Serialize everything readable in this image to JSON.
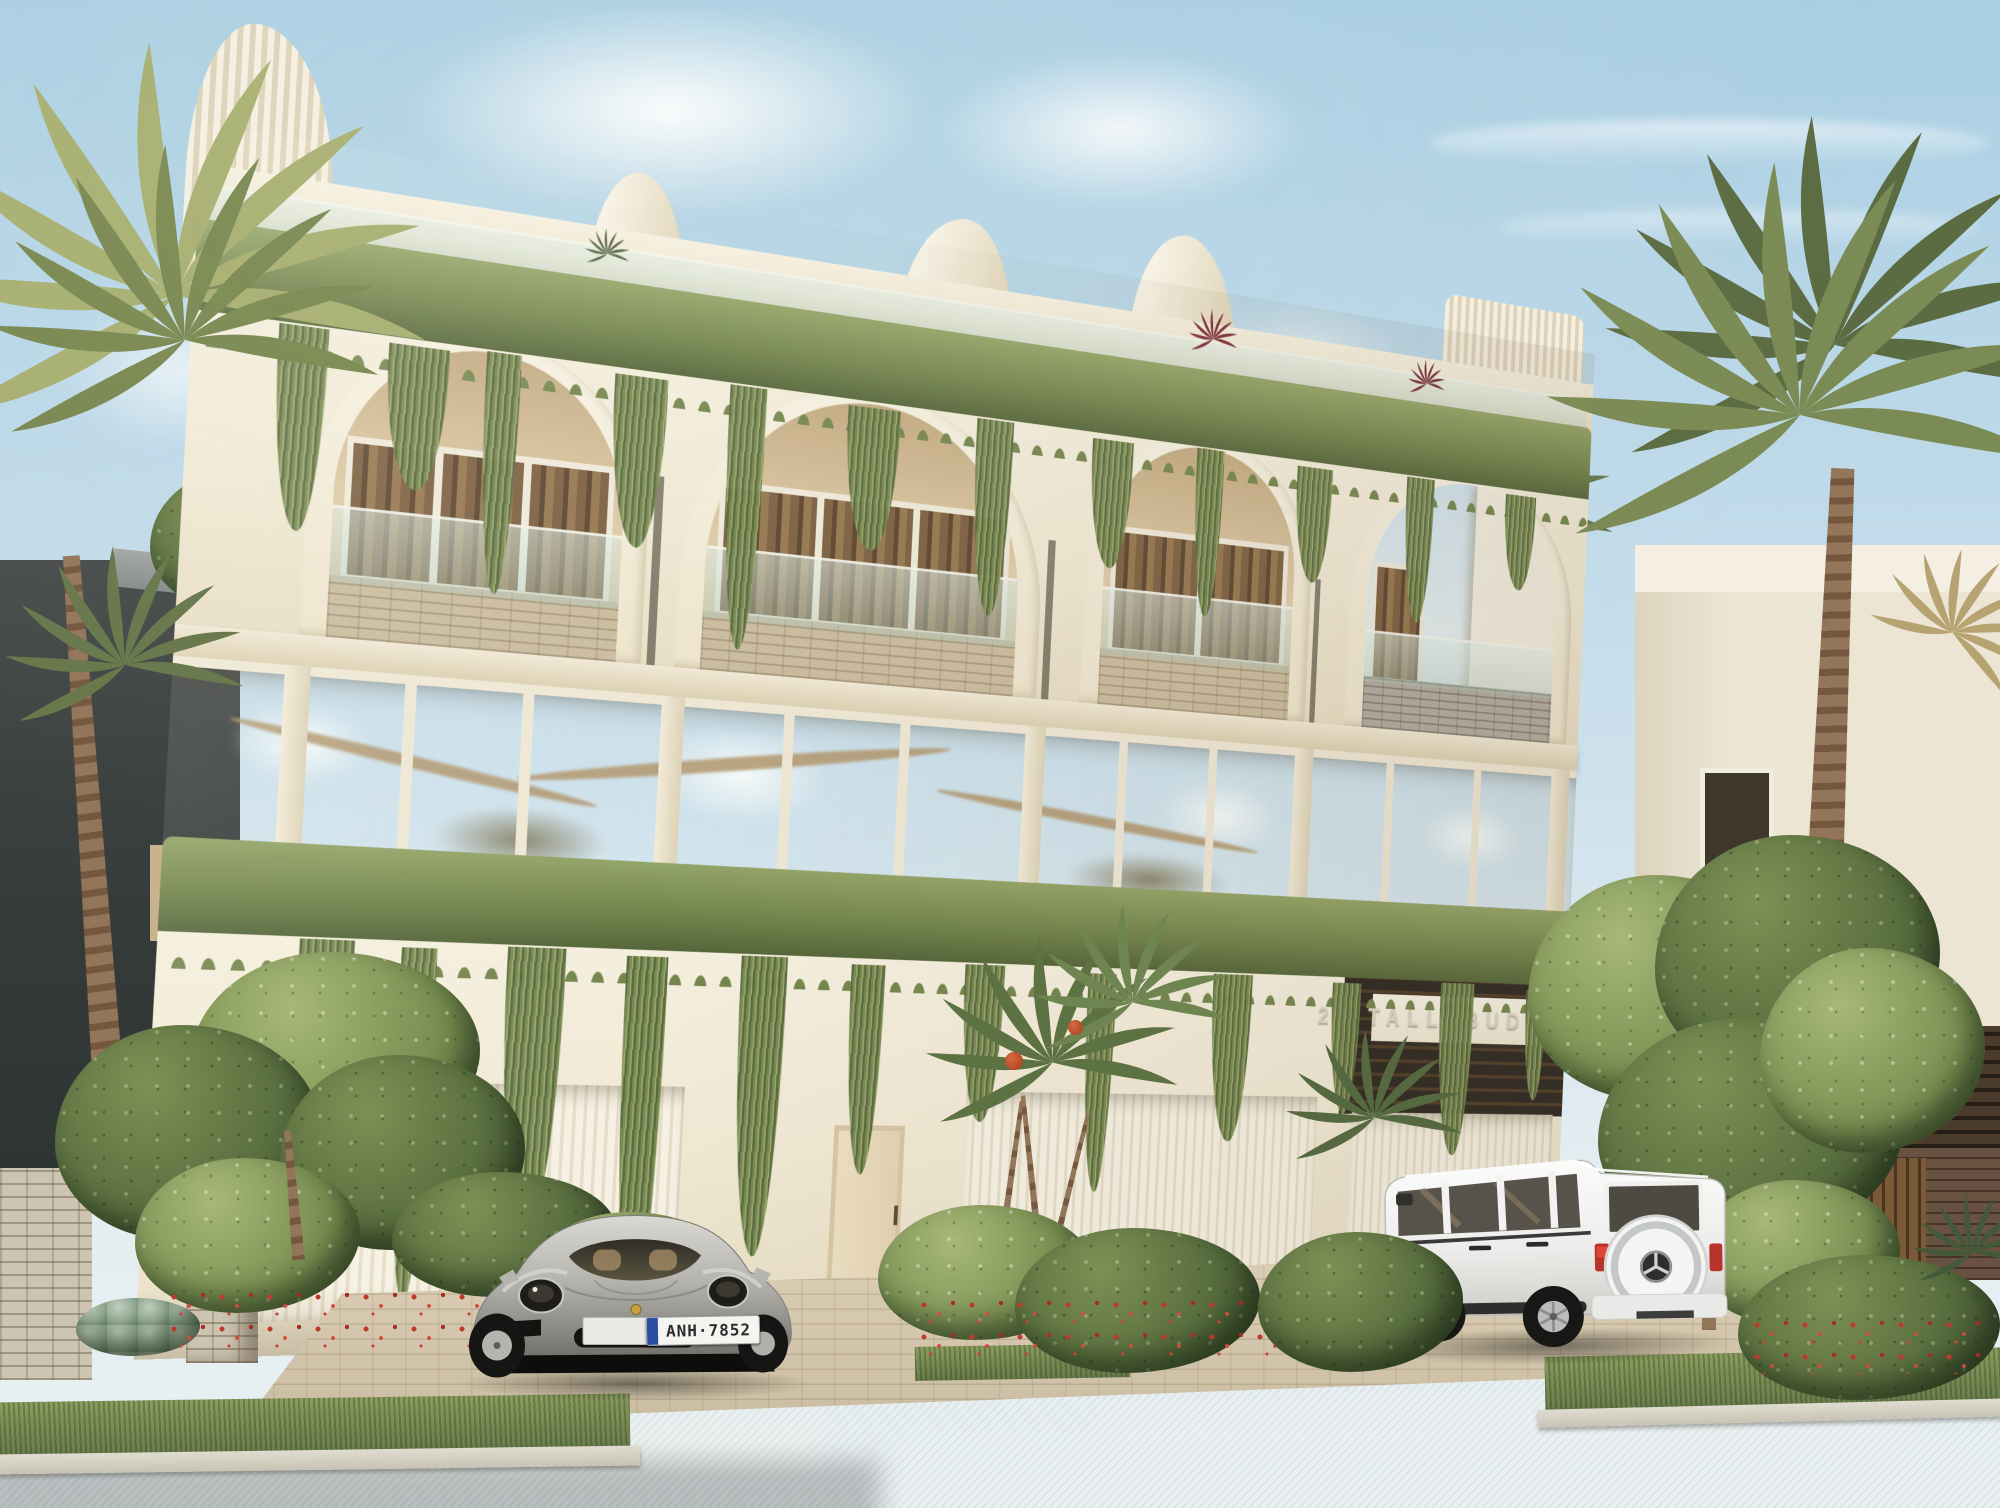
{
  "image_type": "photorealistic exterior render of a three-storey arched townhouse building with lush greenery",
  "signage": {
    "building_sign": "26 TALLEBUDGERA"
  },
  "vehicles": {
    "sports_car": {
      "body": "silver sports coupe",
      "license_plate": "ANH·7852"
    },
    "suv": {
      "body": "white boxy luxury SUV with rear-mounted spare wheel"
    }
  },
  "building": {
    "storeys": 3,
    "arched_balconies": 4,
    "garage_doors": 3,
    "visible_features": [
      "rooftop garden with cascading vines",
      "sculptural rounded roof fins",
      "glass balustrades",
      "brick balcony parapets",
      "full-height reflective glazing",
      "fluted garage doors",
      "hanging planter band",
      "tropical landscaping with palms and red flowers"
    ]
  },
  "palette": {
    "sky_top": "#a9cfe3",
    "sky_mid": "#c3dcea",
    "horizon": "#e3edf1",
    "cloud": "#ffffff",
    "cream": "#f0e8d3",
    "cream_light": "#f6f0e0",
    "cream_shadow": "#ddd0b4",
    "recess_tan": "#d6c09b",
    "recess_dark": "#c2a981",
    "curtain": "#7c5f41",
    "curtain_dark": "#5c452f",
    "brickbeige": "#cabb9f",
    "glass_tan": "#d6c4a1",
    "vine": "#74864e",
    "vine_light": "#93a468",
    "vine_dark": "#55663a",
    "palm": "#7b8b55",
    "palm_light": "#a6ae6f",
    "palm_dark": "#5c6c42",
    "trunk": "#84674c",
    "dark_wall": "#3c4140",
    "garage_door": "#f2ece0",
    "sign_text": "#ddd6c2",
    "road": "#9b9a97",
    "curb": "#d9d4c8",
    "paver": "#d5c9b0",
    "grass": "#7a9054",
    "flower": "#bf3a2e",
    "roof_accent": "#7e2b36",
    "silver": "#b9b7b2",
    "white_car": "#f4f4f2",
    "taillight": "#c0392f",
    "plate_blue": "#2a4fa2"
  }
}
